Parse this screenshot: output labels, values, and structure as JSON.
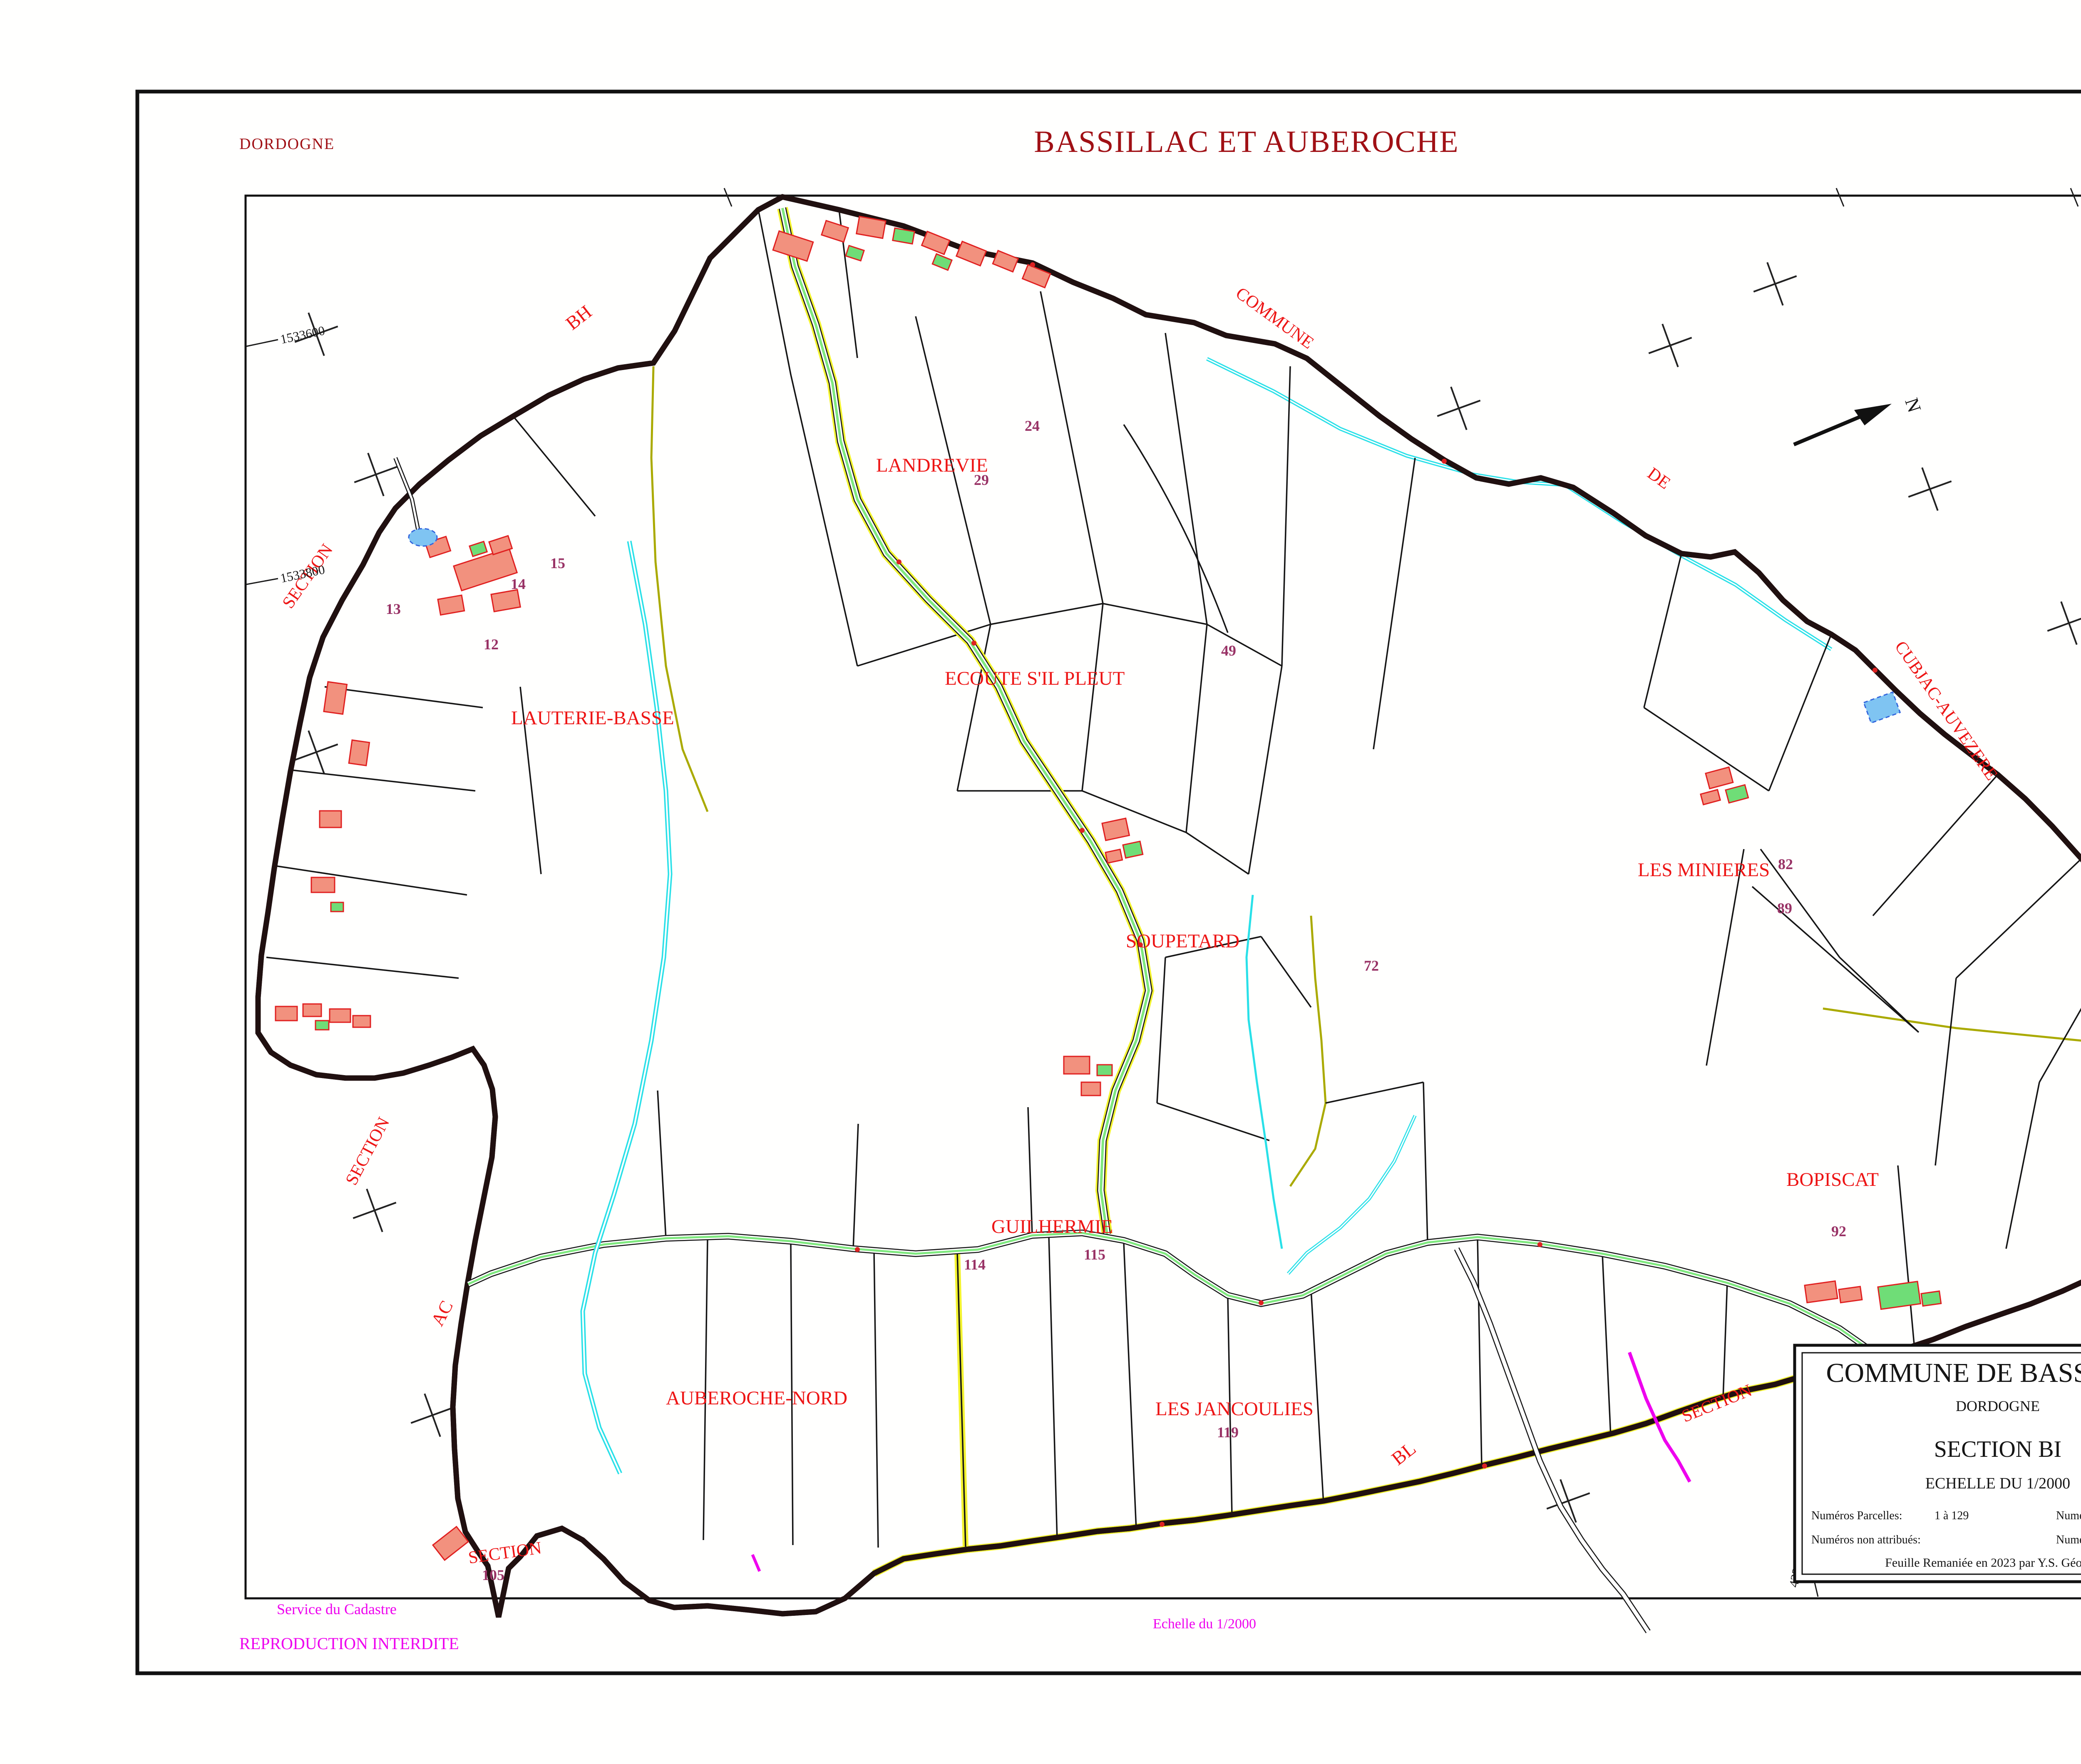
{
  "header": {
    "department": "DORDOGNE",
    "title": "BASSILLAC ET AUBEROCHE",
    "section": "SECTION   BI"
  },
  "cartouche": {
    "commune": "COMMUNE DE BASSILLAC",
    "department": "DORDOGNE",
    "section": "SECTION  BI",
    "scale": "ECHELLE  DU  1/2000",
    "parcels_label": "Numéros Parcelles:",
    "parcels_value": "1 à 129",
    "intercalated_label": "Numéros intercalés:",
    "unassigned_label": "Numéros non attribués:",
    "nfp_label": "Numéros NFP:",
    "note": "Feuille Remaniée en 2023 par Y.S. Géomètre"
  },
  "footer": {
    "service": "Service du Cadastre",
    "reproduction": "REPRODUCTION  INTERDITE",
    "scale_label": "Echelle du 1/",
    "scale_value": "2000",
    "revision": "Feuille remaniée pour 2023"
  },
  "compass": {
    "label": "N"
  },
  "place_names": [
    {
      "text": "LANDREVIE"
    },
    {
      "text": "ECOUTE S'IL PLEUT"
    },
    {
      "text": "LAUTERIE-BASSE"
    },
    {
      "text": "LES MINIERES"
    },
    {
      "text": "SOUPETARD"
    },
    {
      "text": "GUILHERMIE"
    },
    {
      "text": "BOPISCAT"
    },
    {
      "text": "AUBEROCHE-NORD"
    },
    {
      "text": "LES JANCOULIES"
    }
  ],
  "boundary_labels": [
    {
      "text": "BH"
    },
    {
      "text": "COMMUNE"
    },
    {
      "text": "DE"
    },
    {
      "text": "CUBJAC-AUVEZERE"
    },
    {
      "text": "SECTION"
    },
    {
      "text": "SECTION"
    },
    {
      "text": "AC"
    },
    {
      "text": "SECTION"
    },
    {
      "text": "SECTION"
    },
    {
      "text": "BL"
    },
    {
      "text": "BK"
    }
  ],
  "grid_labels": [
    {
      "text": "1533600"
    },
    {
      "text": "1533800"
    },
    {
      "text": "1535200"
    },
    {
      "text": "4236600"
    }
  ],
  "parcel_numbers": [
    {
      "n": "12"
    },
    {
      "n": "13"
    },
    {
      "n": "14"
    },
    {
      "n": "15"
    },
    {
      "n": "24"
    },
    {
      "n": "29"
    },
    {
      "n": "49"
    },
    {
      "n": "72"
    },
    {
      "n": "82"
    },
    {
      "n": "89"
    },
    {
      "n": "92"
    },
    {
      "n": "105"
    },
    {
      "n": "114"
    },
    {
      "n": "115"
    },
    {
      "n": "119"
    }
  ],
  "colors": {
    "title_red": "#A01015",
    "label_red": "#ED1515",
    "magenta": "#EE00EE",
    "parcel_purple": "#993366",
    "road_green": "#7FE87F",
    "path_yellow": "#F2F22E",
    "water_cyan": "#29E0E8",
    "building_fill": "#F2917E",
    "building_green": "#6FDD77",
    "building_stroke": "#E02020",
    "line_olive": "#AAAA00",
    "frame_black": "#111111"
  }
}
